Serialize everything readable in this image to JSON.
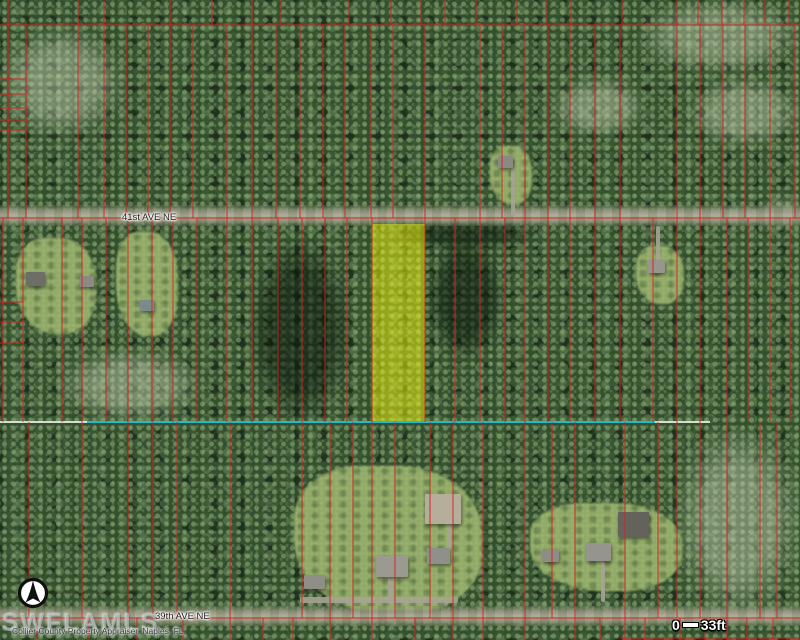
{
  "map": {
    "watermark": "SWFLAMLS",
    "attribution": "Collier County Property Appraiser, Naples, FL.",
    "scale": {
      "start": "0",
      "end": "33ft"
    },
    "roads": [
      {
        "name": "41st AVE NE",
        "label_x": 122,
        "label_y": 212
      },
      {
        "name": "39th AVE NE",
        "label_x": 155,
        "label_y": 611
      }
    ],
    "colors": {
      "parcel_line": "#d81e1e",
      "highlight_fill": "#f2f50a",
      "section_line_cyan": "#18b7c9",
      "section_line_white": "#e9e9e0",
      "road_label_text": "#222222",
      "scale_text": "#ffffff",
      "forest_base": "#33502e"
    },
    "icons": {
      "compass": "north-arrow-icon"
    },
    "highlight_parcel": {
      "x": 372,
      "y": 224,
      "w": 53,
      "h": 198
    },
    "section_line": {
      "y": 422,
      "white_x1": 0,
      "white_x2": 710,
      "cyan_x1": 87,
      "cyan_x2": 655
    },
    "parcel_lines": {
      "horizontal": [
        {
          "y": 25,
          "x1": 0,
          "x2": 800
        },
        {
          "y": 218,
          "x1": 0,
          "x2": 800
        },
        {
          "y": 618,
          "x1": 0,
          "x2": 800
        },
        {
          "y": 638,
          "x1": 620,
          "x2": 800
        },
        {
          "y": 79,
          "x1": 0,
          "x2": 26
        },
        {
          "y": 94,
          "x1": 0,
          "x2": 26
        },
        {
          "y": 108,
          "x1": 0,
          "x2": 26
        },
        {
          "y": 120,
          "x1": 0,
          "x2": 26
        },
        {
          "y": 130,
          "x1": 0,
          "x2": 26
        },
        {
          "y": 302,
          "x1": 0,
          "x2": 23
        },
        {
          "y": 322,
          "x1": 0,
          "x2": 23
        },
        {
          "y": 343,
          "x1": 0,
          "x2": 23
        }
      ],
      "vertical_bands": [
        {
          "y1": 0,
          "y2": 25,
          "xs": [
            8,
            78,
            104,
            170,
            212,
            252,
            281,
            349,
            391,
            421,
            445,
            476,
            517,
            546,
            571,
            622,
            677,
            698,
            722,
            744,
            765,
            789
          ]
        },
        {
          "y1": 25,
          "y2": 218,
          "xs": [
            8,
            26,
            78,
            104,
            126,
            148,
            170,
            193,
            227,
            252,
            276,
            300,
            323,
            345,
            371,
            393,
            425,
            480,
            502,
            525,
            548,
            570,
            595,
            620,
            677,
            700,
            723,
            745,
            770,
            795
          ]
        },
        {
          "y1": 218,
          "y2": 422,
          "xs": [
            3,
            23,
            62,
            82,
            106,
            128,
            152,
            173,
            197,
            227,
            252,
            278,
            302,
            325,
            347,
            372,
            425,
            455,
            480,
            505,
            525,
            548,
            570,
            595,
            620,
            653,
            677,
            700,
            727,
            748,
            770,
            790
          ]
        },
        {
          "y1": 422,
          "y2": 618,
          "xs": [
            29,
            82,
            128,
            153,
            177,
            230,
            302,
            330,
            353,
            372,
            395,
            430,
            453,
            483,
            525,
            552,
            575,
            625,
            658,
            677,
            700,
            727,
            760,
            777
          ]
        },
        {
          "y1": 618,
          "y2": 640,
          "xs": [
            36,
            88,
            137,
            183,
            230,
            263,
            293,
            330,
            372,
            415,
            453,
            483,
            525,
            575,
            600,
            625,
            645,
            680,
            705,
            727,
            747,
            773
          ]
        }
      ]
    },
    "vegetation_patches": [
      {
        "type": "light",
        "x": 640,
        "y": 0,
        "w": 160,
        "h": 72
      },
      {
        "type": "light",
        "x": 688,
        "y": 78,
        "w": 112,
        "h": 68
      },
      {
        "type": "light",
        "x": 676,
        "y": 428,
        "w": 124,
        "h": 186
      },
      {
        "type": "light",
        "x": 0,
        "y": 28,
        "w": 122,
        "h": 108
      },
      {
        "type": "light",
        "x": 552,
        "y": 78,
        "w": 92,
        "h": 58
      },
      {
        "type": "light",
        "x": 766,
        "y": 198,
        "w": 34,
        "h": 30
      },
      {
        "type": "light",
        "x": 60,
        "y": 350,
        "w": 140,
        "h": 70
      },
      {
        "type": "dark",
        "x": 388,
        "y": 220,
        "w": 150,
        "h": 28
      },
      {
        "type": "dark",
        "x": 250,
        "y": 238,
        "w": 100,
        "h": 184
      },
      {
        "type": "dark",
        "x": 428,
        "y": 238,
        "w": 75,
        "h": 120
      }
    ],
    "clearings": [
      {
        "x": 16,
        "y": 238,
        "w": 80,
        "h": 96
      },
      {
        "x": 116,
        "y": 232,
        "w": 62,
        "h": 104
      },
      {
        "x": 636,
        "y": 246,
        "w": 48,
        "h": 58
      },
      {
        "x": 490,
        "y": 146,
        "w": 42,
        "h": 58
      },
      {
        "x": 294,
        "y": 466,
        "w": 188,
        "h": 148
      },
      {
        "x": 530,
        "y": 503,
        "w": 152,
        "h": 88
      }
    ],
    "buildings": [
      {
        "x": 26,
        "y": 272,
        "w": 19,
        "h": 14,
        "c": "#6e6e68"
      },
      {
        "x": 80,
        "y": 276,
        "w": 14,
        "h": 11,
        "c": "#8a8a82"
      },
      {
        "x": 140,
        "y": 300,
        "w": 14,
        "h": 11,
        "c": "#7d8a8a"
      },
      {
        "x": 498,
        "y": 156,
        "w": 15,
        "h": 12,
        "c": "#8a8a82"
      },
      {
        "x": 648,
        "y": 260,
        "w": 17,
        "h": 13,
        "c": "#96968e"
      },
      {
        "x": 376,
        "y": 556,
        "w": 32,
        "h": 21,
        "c": "#9a9a92"
      },
      {
        "x": 304,
        "y": 575,
        "w": 21,
        "h": 14,
        "c": "#8f8f87"
      },
      {
        "x": 427,
        "y": 548,
        "w": 23,
        "h": 16,
        "c": "#90908a"
      },
      {
        "x": 425,
        "y": 494,
        "w": 36,
        "h": 30,
        "c": "#b5ae9a"
      },
      {
        "x": 542,
        "y": 549,
        "w": 17,
        "h": 13,
        "c": "#8d8d85"
      },
      {
        "x": 586,
        "y": 543,
        "w": 25,
        "h": 18,
        "c": "#95958d"
      },
      {
        "x": 618,
        "y": 512,
        "w": 31,
        "h": 25,
        "c": "#63635c"
      }
    ],
    "driveways": [
      {
        "x": 511,
        "y": 168,
        "w": 4,
        "h": 48
      },
      {
        "x": 656,
        "y": 226,
        "w": 4,
        "h": 36
      },
      {
        "x": 300,
        "y": 597,
        "w": 158,
        "h": 6
      },
      {
        "x": 388,
        "y": 578,
        "w": 5,
        "h": 22
      },
      {
        "x": 447,
        "y": 524,
        "w": 4,
        "h": 26
      },
      {
        "x": 601,
        "y": 562,
        "w": 4,
        "h": 40
      }
    ]
  }
}
